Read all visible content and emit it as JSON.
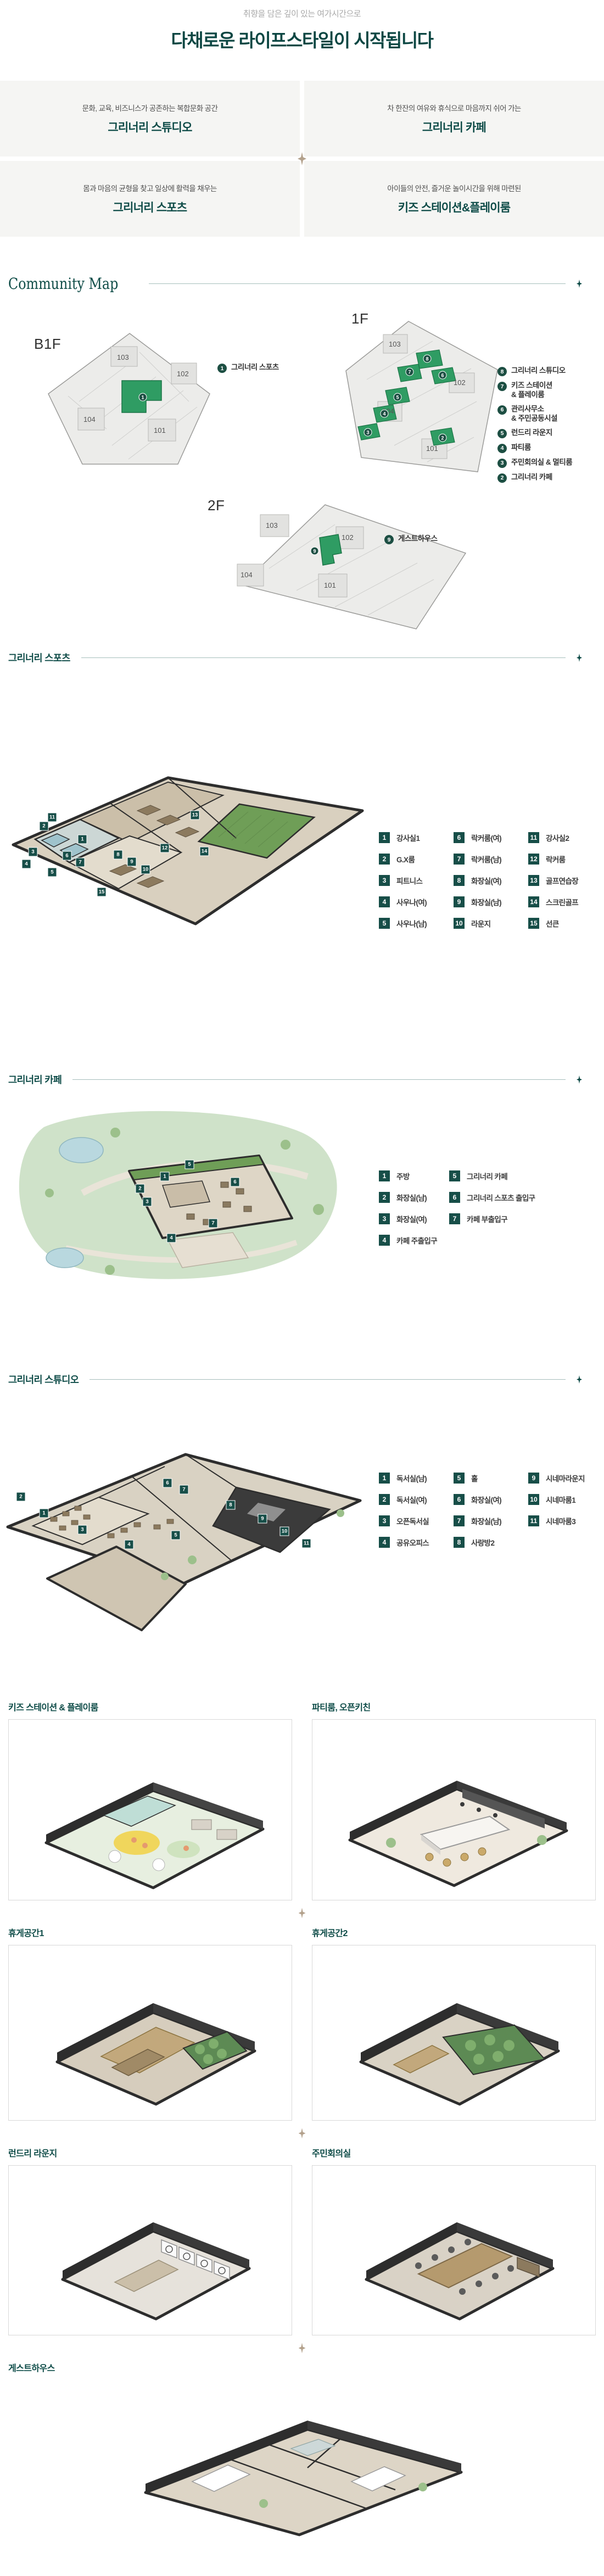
{
  "header": {
    "subtitle": "취향을 담은 깊이 있는 여가시간으로",
    "title": "다채로운 라이프스타일이 시작됩니다"
  },
  "cards": [
    {
      "desc": "문화, 교육, 비즈니스가 공존하는 복합문화 공간",
      "title": "그리너리 스튜디오"
    },
    {
      "desc": "차 한잔의 여유와 휴식으로 마음까지 쉬어 가는",
      "title": "그리너리 카페"
    },
    {
      "desc": "몸과 마음의 균형을 찾고 일상에 활력을 채우는",
      "title": "그리너리 스포츠"
    },
    {
      "desc": "아이들의 안전, 즐거운 놀이시간을 위해 마련된",
      "title": "키즈 스테이션&플레이룸"
    }
  ],
  "community_map": {
    "heading": "Community Map",
    "floors": [
      {
        "label": "B1F",
        "buildings": [
          "103",
          "102",
          "104",
          "101"
        ],
        "legend": [
          {
            "num": "1",
            "label": "그리너리 스포츠"
          }
        ]
      },
      {
        "label": "1F",
        "buildings": [
          "103",
          "102",
          "104",
          "101"
        ],
        "legend": [
          {
            "num": "8",
            "label": "그리너리 스튜디오"
          },
          {
            "num": "7",
            "label": "키즈 스테이션",
            "label2": "& 플레이룸"
          },
          {
            "num": "6",
            "label": "관리사무소",
            "label2": "& 주민공동시설"
          },
          {
            "num": "5",
            "label": "런드리 라운지"
          },
          {
            "num": "4",
            "label": "파티룸"
          },
          {
            "num": "3",
            "label": "주민회의실 & 멀티룸"
          },
          {
            "num": "2",
            "label": "그리너리 카페"
          }
        ]
      },
      {
        "label": "2F",
        "buildings": [
          "103",
          "102",
          "104",
          "101"
        ],
        "legend": [
          {
            "num": "9",
            "label": "게스트하우스"
          }
        ]
      }
    ]
  },
  "sections": [
    {
      "title": "그리너리 스포츠",
      "legend": [
        {
          "num": "1",
          "label": "강사실1"
        },
        {
          "num": "2",
          "label": "G.X룸"
        },
        {
          "num": "3",
          "label": "피트니스"
        },
        {
          "num": "4",
          "label": "사우나(여)"
        },
        {
          "num": "5",
          "label": "사우나(남)"
        },
        {
          "num": "6",
          "label": "락커룸(여)"
        },
        {
          "num": "7",
          "label": "락커룸(남)"
        },
        {
          "num": "8",
          "label": "화장실(여)"
        },
        {
          "num": "9",
          "label": "화장실(남)"
        },
        {
          "num": "10",
          "label": "라운지"
        },
        {
          "num": "11",
          "label": "강사실2"
        },
        {
          "num": "12",
          "label": "락커룸"
        },
        {
          "num": "13",
          "label": "골프연습장"
        },
        {
          "num": "14",
          "label": "스크린골프"
        },
        {
          "num": "15",
          "label": "선큰"
        }
      ]
    },
    {
      "title": "그리너리 카페",
      "legend": [
        {
          "num": "1",
          "label": "주방"
        },
        {
          "num": "2",
          "label": "화장실(남)"
        },
        {
          "num": "3",
          "label": "화장실(여)"
        },
        {
          "num": "4",
          "label": "카페 주출입구"
        },
        {
          "num": "5",
          "label": "그리너리 카페"
        },
        {
          "num": "6",
          "label": "그리너리 스포츠 출입구"
        },
        {
          "num": "7",
          "label": "카페 부출입구"
        }
      ]
    },
    {
      "title": "그리너리 스튜디오",
      "legend": [
        {
          "num": "1",
          "label": "독서실(남)"
        },
        {
          "num": "2",
          "label": "독서실(여)"
        },
        {
          "num": "3",
          "label": "오픈독서실"
        },
        {
          "num": "4",
          "label": "공유오피스"
        },
        {
          "num": "5",
          "label": "홀"
        },
        {
          "num": "6",
          "label": "화장실(여)"
        },
        {
          "num": "7",
          "label": "화장실(남)"
        },
        {
          "num": "8",
          "label": "사랑방2"
        },
        {
          "num": "9",
          "label": "시네마라운지"
        },
        {
          "num": "10",
          "label": "시네마룸1"
        },
        {
          "num": "11",
          "label": "시네마룸3"
        }
      ]
    }
  ],
  "rooms": [
    {
      "title": "키즈 스테이션 & 플레이룸"
    },
    {
      "title": "파티룸, 오픈키친"
    },
    {
      "title": "휴게공간1"
    },
    {
      "title": "휴게공간2"
    },
    {
      "title": "런드리 라운지"
    },
    {
      "title": "주민회의실"
    },
    {
      "title": "게스트하우스"
    }
  ],
  "colors": {
    "accent_teal": "#0d4b47",
    "badge_teal": "#174e48",
    "map_badge_green": "#1d4f43",
    "map_green": "#2f9c63",
    "diamond_tan": "#b3a18c",
    "card_bg": "#f5f5f3"
  }
}
